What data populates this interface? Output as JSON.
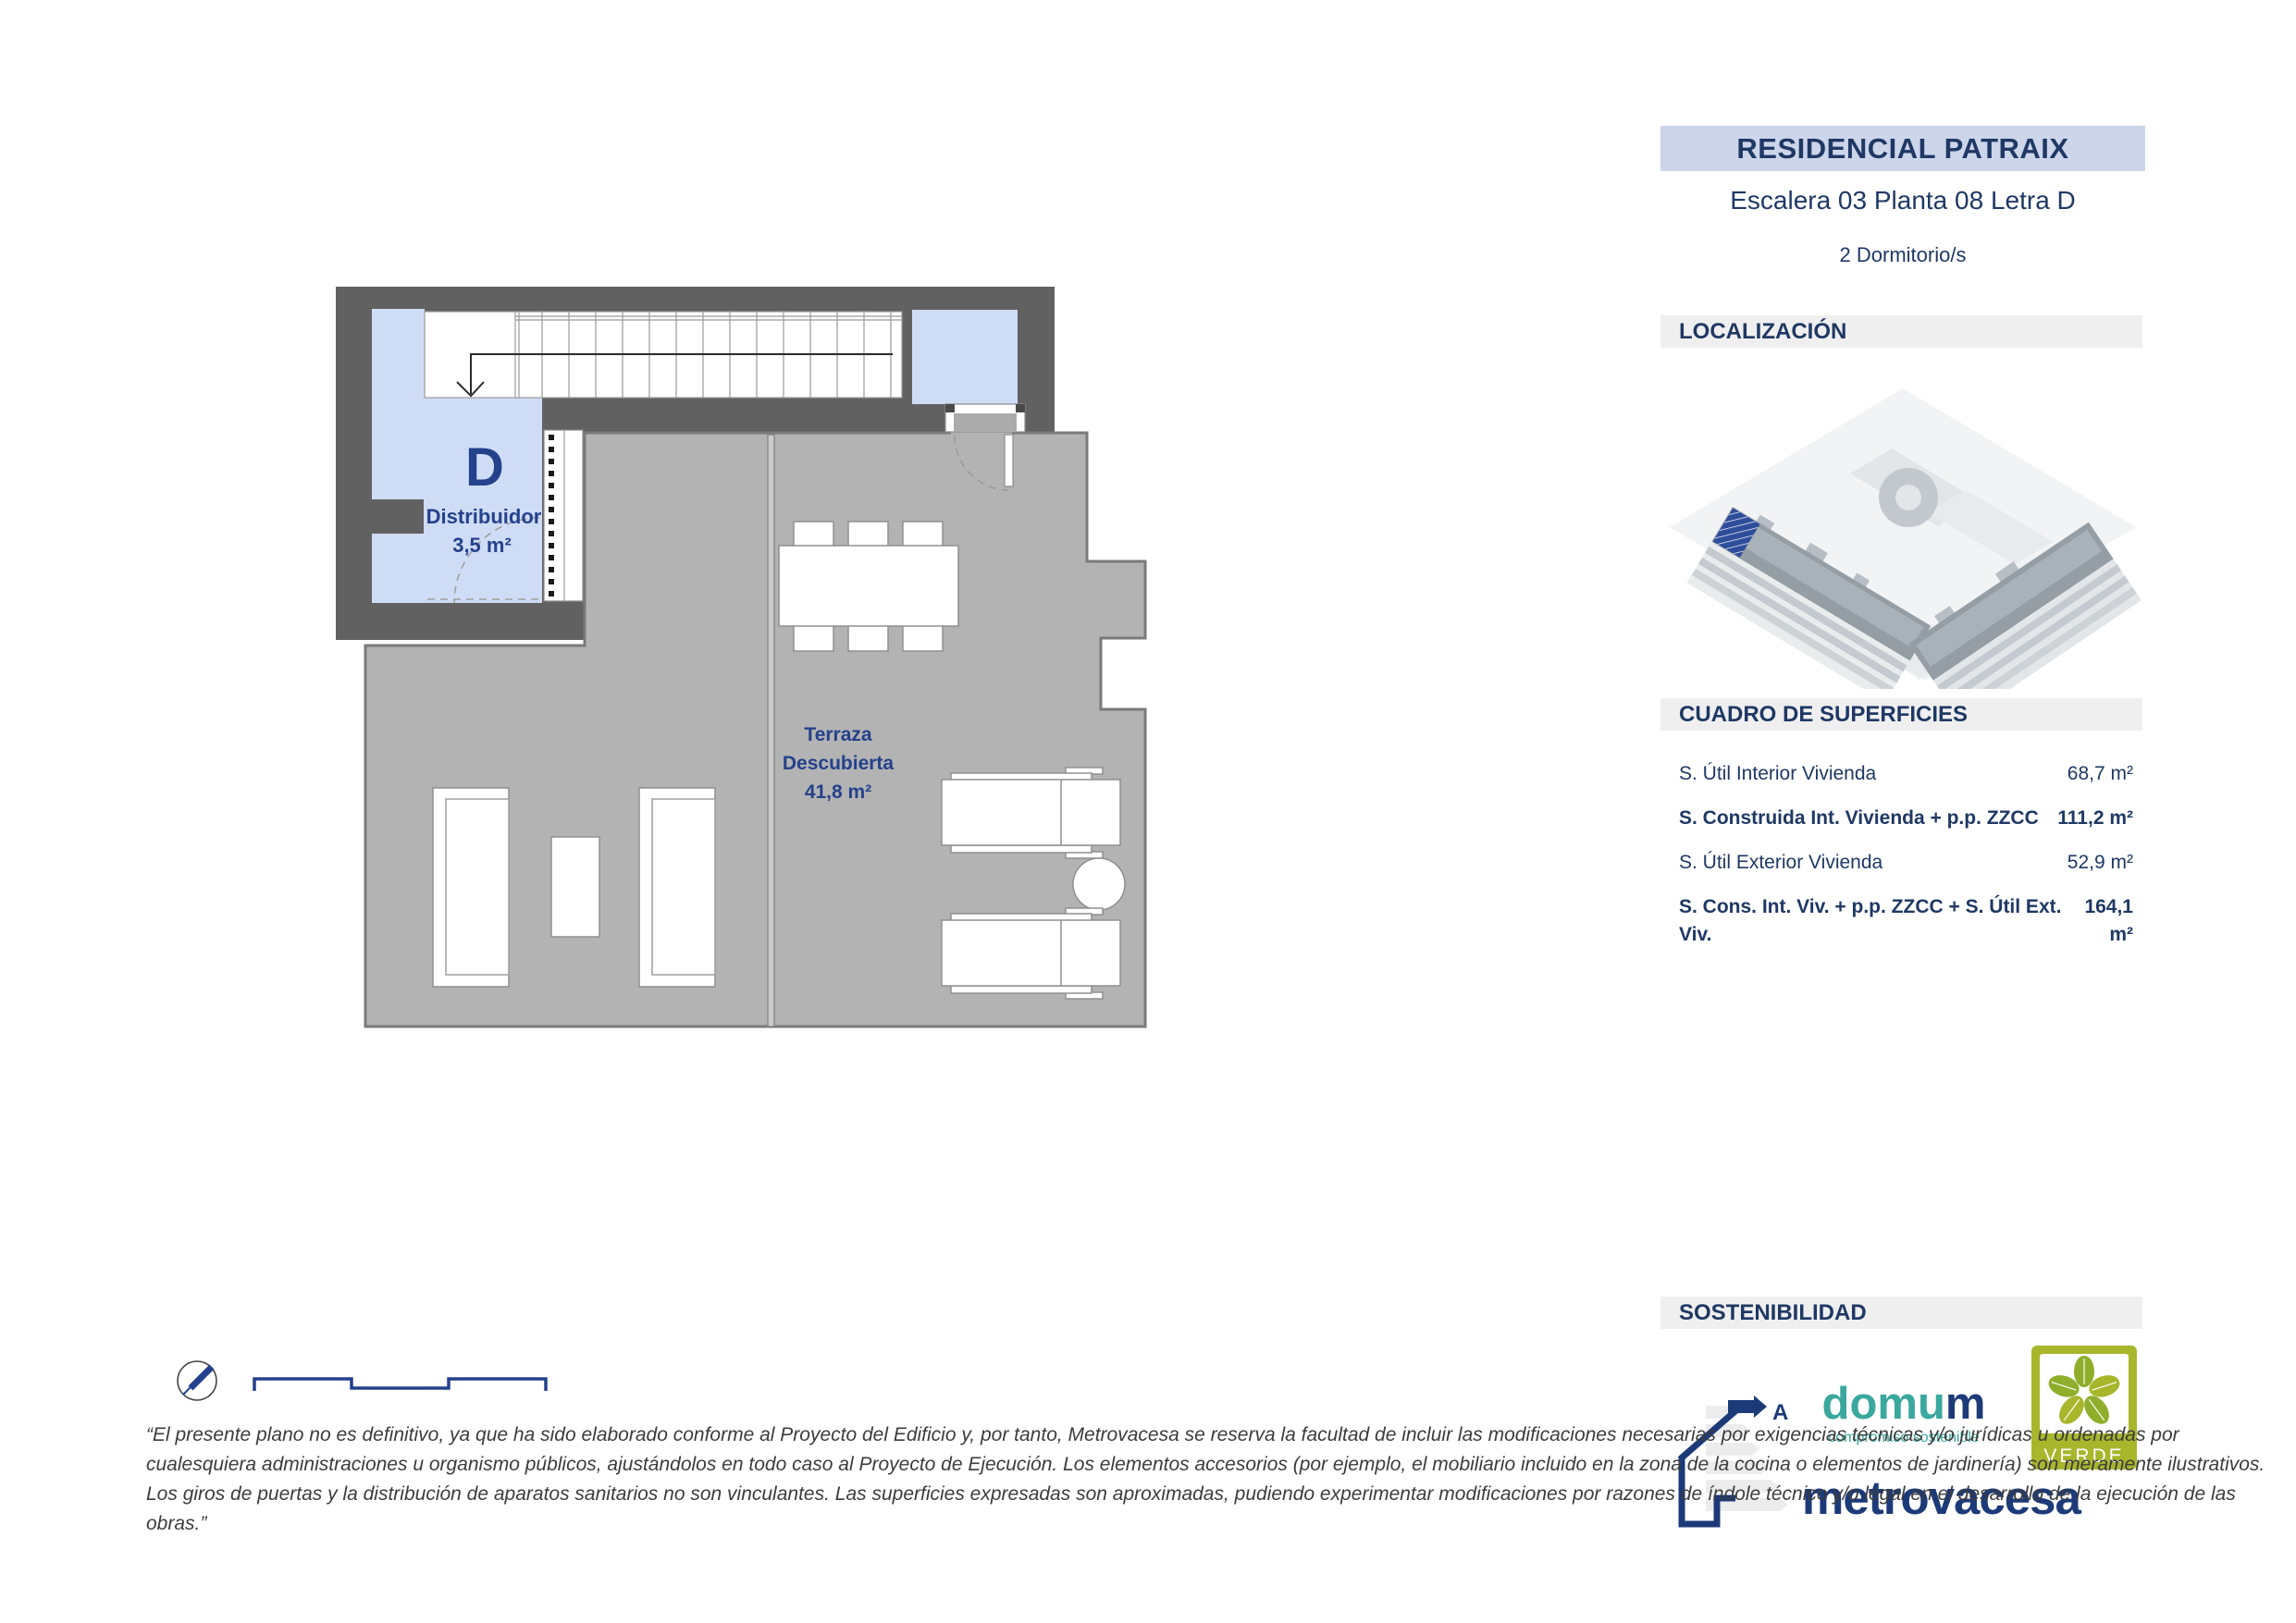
{
  "header": {
    "title": "RESIDENCIAL PATRAIX",
    "subtitle": "Escalera 03 Planta 08 Letra D",
    "bedrooms": "2 Dormitorio/s"
  },
  "sections": {
    "localizacion": "LOCALIZACIÓN",
    "superficies": "CUADRO DE SUPERFICIES",
    "sostenibilidad": "SOSTENIBILIDAD"
  },
  "plan": {
    "unit_letter": "D",
    "distribuidor": {
      "name": "Distribuidor",
      "area": "3,5 m²"
    },
    "terraza": {
      "line1": "Terraza",
      "line2": "Descubierta",
      "area": "41,8 m²"
    }
  },
  "superficies": {
    "rows": [
      {
        "label": "S. Útil Interior Vivienda",
        "value": "68,7 m²"
      },
      {
        "label": "S. Construida Int. Vivienda + p.p. ZZCC",
        "value": "111,2 m²"
      },
      {
        "label": "S. Útil Exterior Vivienda",
        "value": "52,9 m²"
      },
      {
        "label": "S. Cons. Int. Viv. + p.p. ZZCC + S. Útil Ext. Viv.",
        "value": "164,1 m²"
      }
    ]
  },
  "sustainability": {
    "energy_rating": "A",
    "domum_teal": "domu",
    "domum_navy": "m",
    "domum_tagline": "compromiso sostenible",
    "metrovacesa": "metrovacesa",
    "verde": "VERDE"
  },
  "disclaimer": {
    "lines": [
      "“El presente plano no es definitivo, ya que ha sido elaborado conforme al Proyecto del Edificio y, por tanto, Metrovacesa se reserva la facultad de incluir las modificaciones necesarias por exigencias técnicas y/o jurídicas u ordenadas por",
      "cualesquiera administraciones u organismo públicos, ajustándolos en todo caso al Proyecto de Ejecución. Los elementos accesorios (por ejemplo, el mobiliario incluido en la zona de la cocina o elementos de jardinería) son meramente ilustrativos.",
      "Los giros de puertas y la distribución de aparatos sanitarios no son vinculantes. Las superficies expresadas son aproximadas, pudiendo experimentar modificaciones por razones de índole técnico y/o legal en el desarrollo de la ejecución de las",
      "obras.”"
    ]
  },
  "colors": {
    "navy": "#1f3864",
    "plan_navy": "#24418c",
    "band_blue": "#ccd5ea",
    "band_gray": "#efefef",
    "wall_dark": "#616161",
    "room_blue": "#cfdcf5",
    "terrace_gray": "#b3b3b3",
    "teal": "#3aa89e",
    "verde_olive": "#a8b62c"
  }
}
